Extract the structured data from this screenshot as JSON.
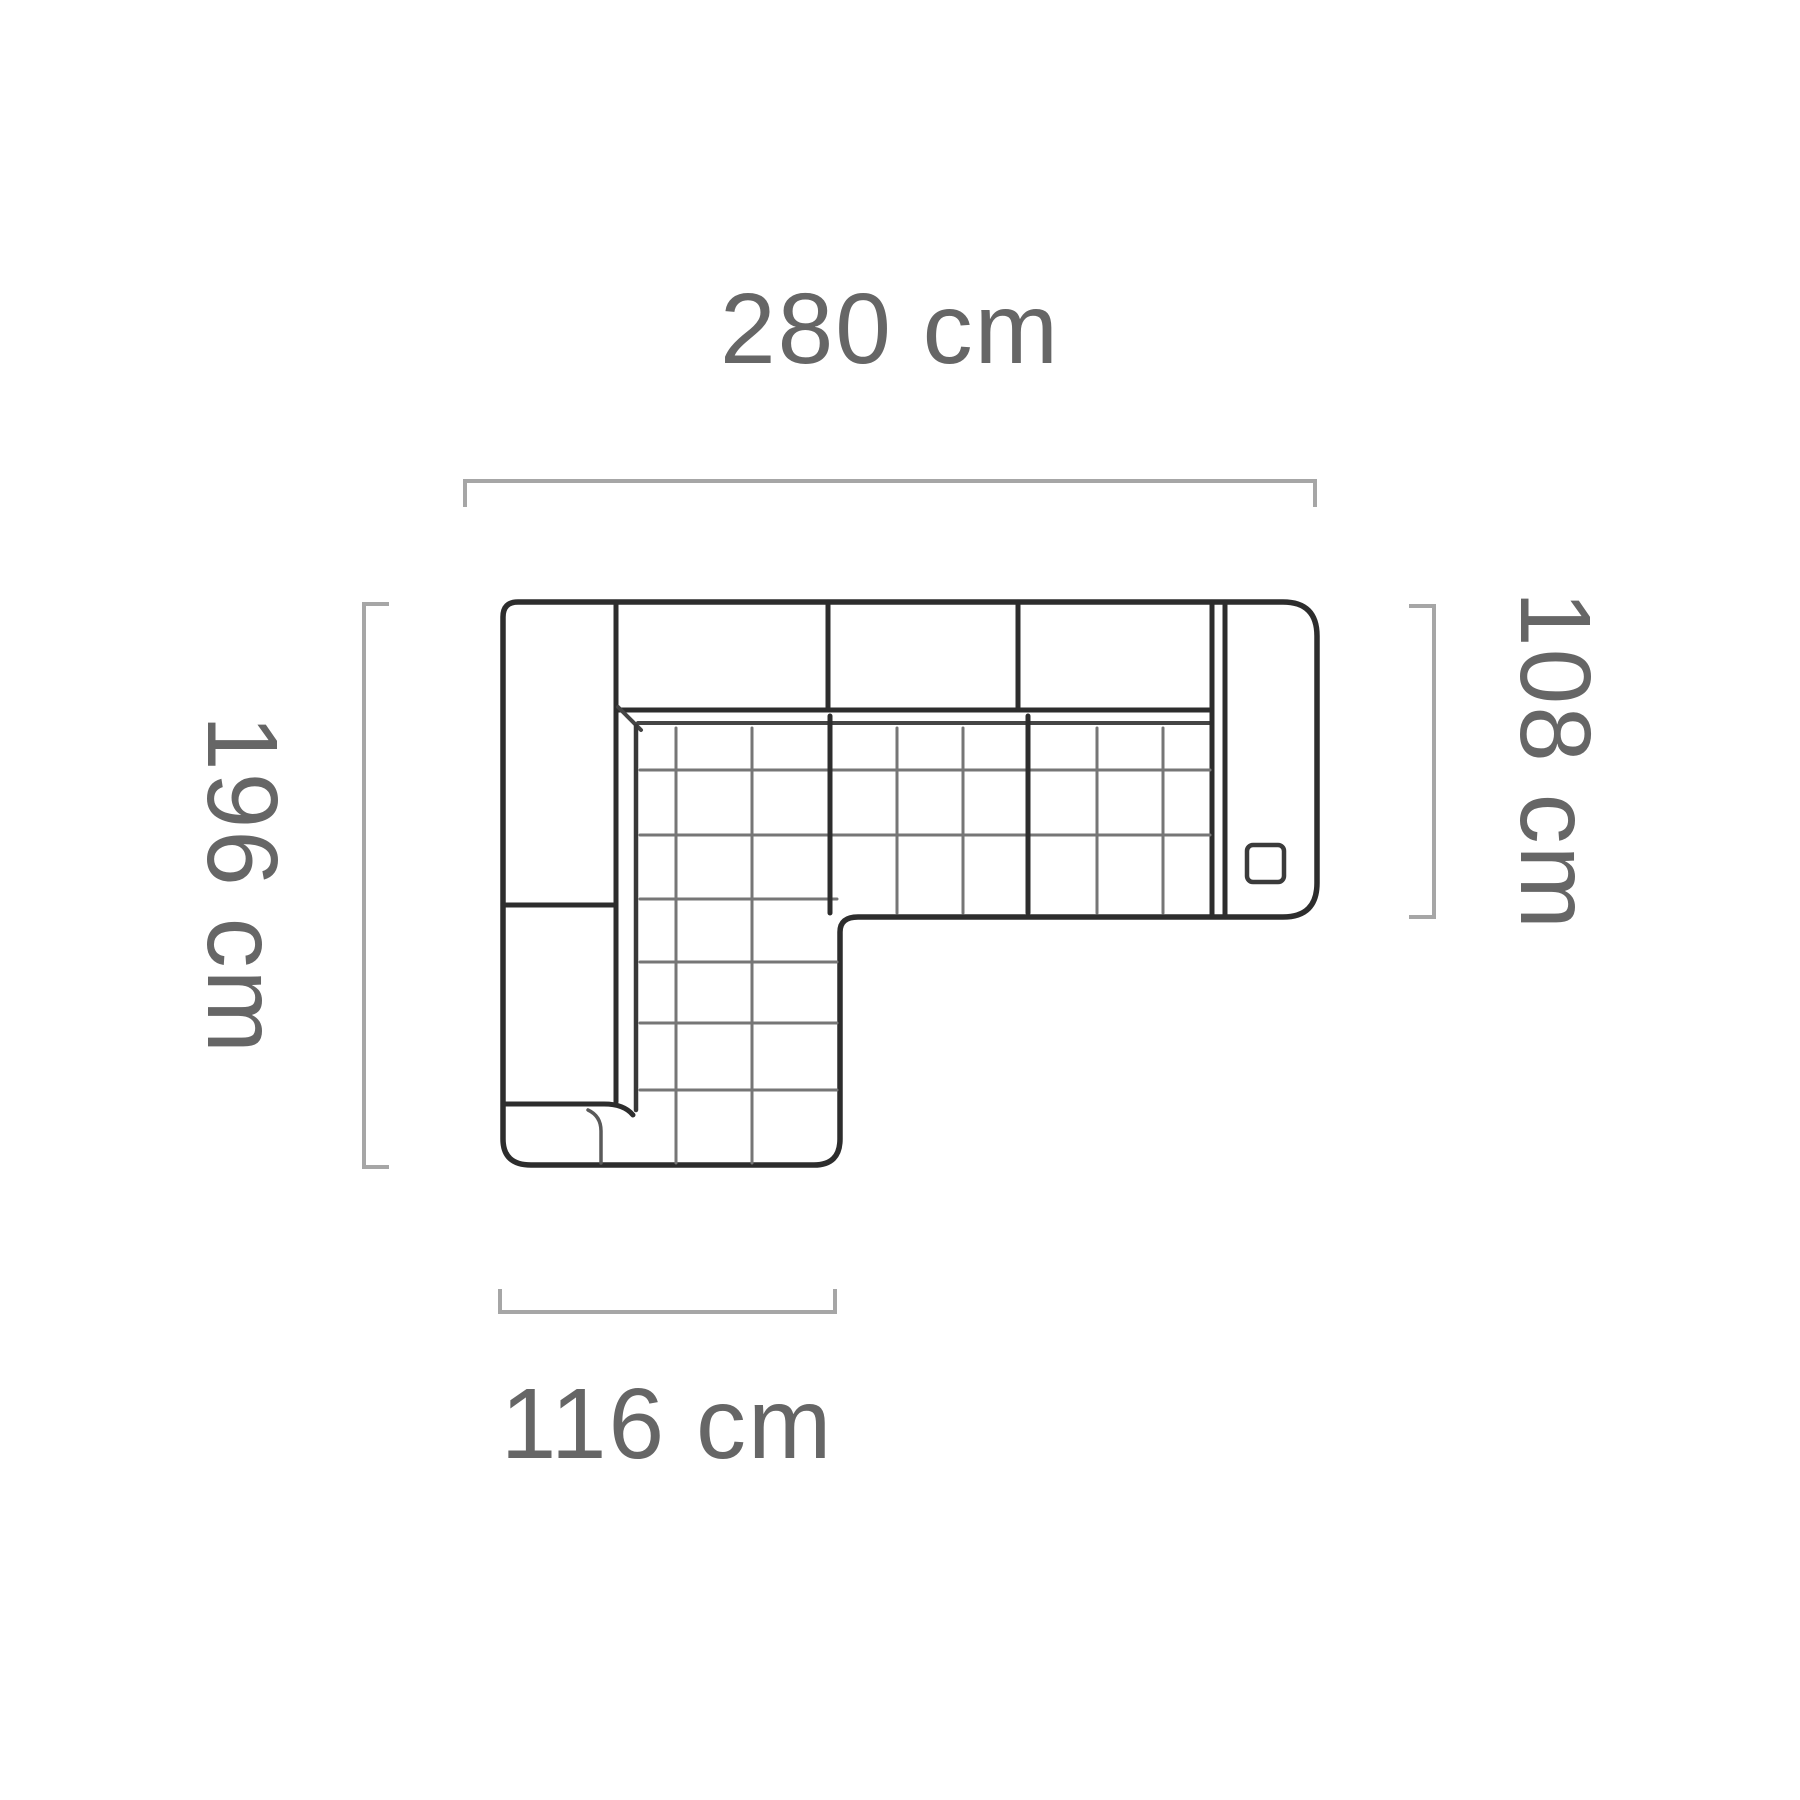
{
  "diagram": {
    "kind": "corner-sofa-top-view-dimension-diagram",
    "unit": "cm",
    "labels": {
      "top": "280 cm",
      "left": "196 cm",
      "right": "108 cm",
      "bottom": "116 cm"
    },
    "values": {
      "top": 280,
      "left": 196,
      "right": 108,
      "bottom": 116
    },
    "colors": {
      "background": "#ffffff",
      "outline": "#2d2d2d",
      "seam": "#454545",
      "quilt_line": "#767676",
      "dimension_line": "#a6a6a6",
      "label_text": "#666666"
    }
  }
}
